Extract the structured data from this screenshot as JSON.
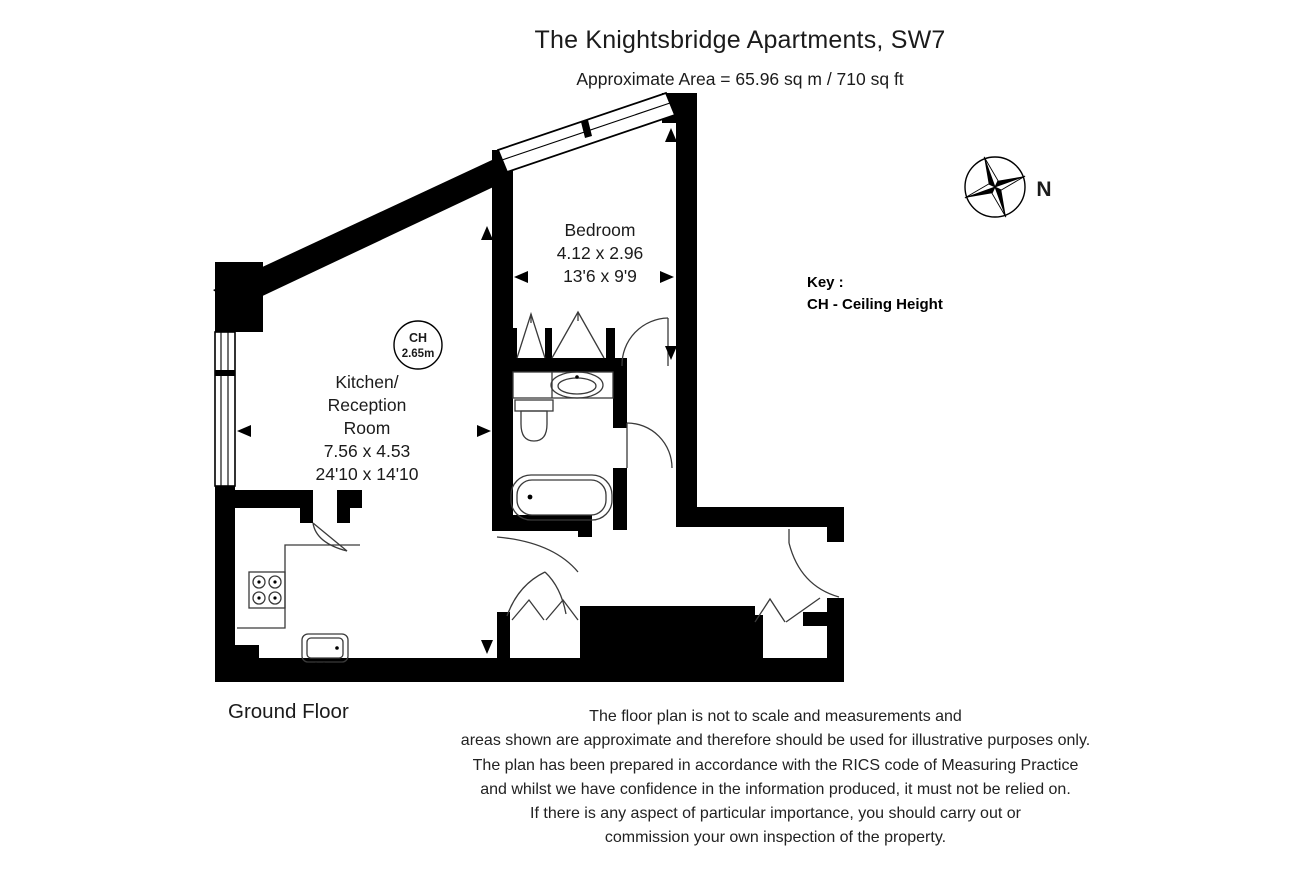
{
  "header": {
    "title": "The Knightsbridge Apartments, SW7",
    "area_line": "Approximate Area = 65.96 sq m / 710 sq ft"
  },
  "compass": {
    "north_label": "N"
  },
  "key": {
    "title": "Key :",
    "entry": "CH - Ceiling Height"
  },
  "floor_label": "Ground Floor",
  "rooms": {
    "bedroom": {
      "name": "Bedroom",
      "metric": "4.12 x 2.96",
      "imperial": "13'6 x 9'9"
    },
    "kitchen": {
      "name_line1": "Kitchen/",
      "name_line2": "Reception",
      "name_line3": "Room",
      "metric": "7.56 x 4.53",
      "imperial": "24'10 x 14'10"
    },
    "ceiling_height": {
      "label": "CH",
      "value": "2.65m"
    }
  },
  "colors": {
    "wall": "#000000",
    "background": "#ffffff"
  },
  "disclaimer": {
    "lines": [
      "The floor plan is not to scale and measurements and",
      "areas shown are approximate and therefore should be used for illustrative purposes only.",
      "The plan has been prepared in accordance with the RICS code of Measuring Practice",
      "and whilst we have confidence in the information produced, it must not be relied on.",
      "If there is any aspect of particular importance, you should carry out or",
      "commission your own inspection of the property."
    ]
  }
}
